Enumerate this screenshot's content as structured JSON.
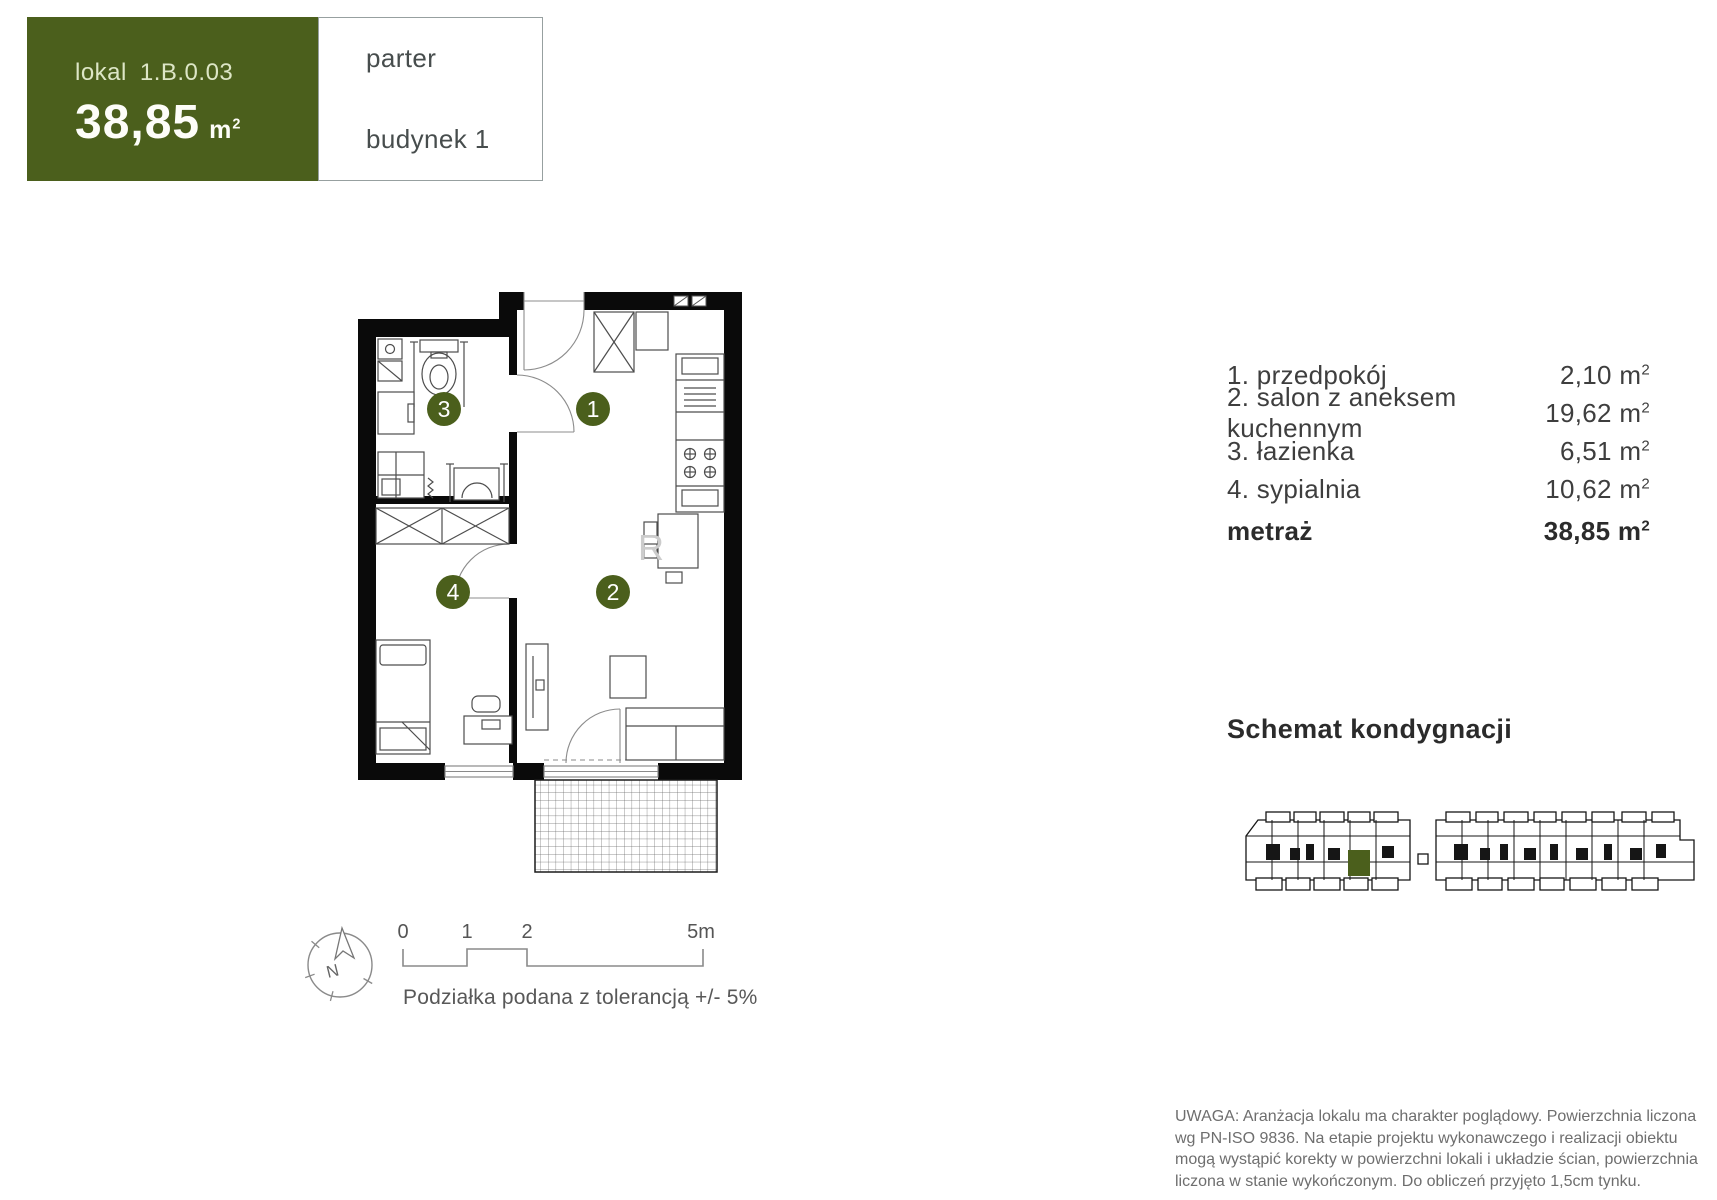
{
  "colors": {
    "green": "#4b5f1c"
  },
  "header": {
    "unit_label": "lokal",
    "unit_number": "1.B.0.03",
    "area": "38,85",
    "area_unit": "m",
    "area_unit_sup": "2"
  },
  "cells": {
    "floor": "parter",
    "building": "budynek 1"
  },
  "rooms": [
    {
      "name": "1. przedpokój",
      "area": "2,10"
    },
    {
      "name": "2. salon z aneksem kuchennym",
      "area": "19,62"
    },
    {
      "name": "3. łazienka",
      "area": "6,51"
    },
    {
      "name": "4. sypialnia",
      "area": "10,62"
    }
  ],
  "units": {
    "m": "m",
    "sup": "2"
  },
  "total": {
    "label": "metraż",
    "area": "38,85"
  },
  "schema": {
    "title": "Schemat kondygnacji"
  },
  "plan": {
    "circles": {
      "hall": "1",
      "living": "2",
      "bathroom": "3",
      "bedroom": "4"
    },
    "watermark": "R"
  },
  "compass": {
    "north": "N"
  },
  "scalebar": {
    "ticks": [
      "0",
      "1",
      "2",
      "5m"
    ]
  },
  "tolerance": "Podziałka podana z tolerancją +/- 5%",
  "disclaimer": [
    "UWAGA: Aranżacja lokalu ma charakter poglądowy. Powierzchnia liczona",
    "wg PN-ISO 9836. Na etapie projektu wykonawczego i realizacji obiektu",
    "mogą wystąpić korekty w powierzchni lokali i układzie ścian, powierzchnia",
    "liczona w stanie wykończonym. Do obliczeń przyjęto 1,5cm tynku."
  ]
}
